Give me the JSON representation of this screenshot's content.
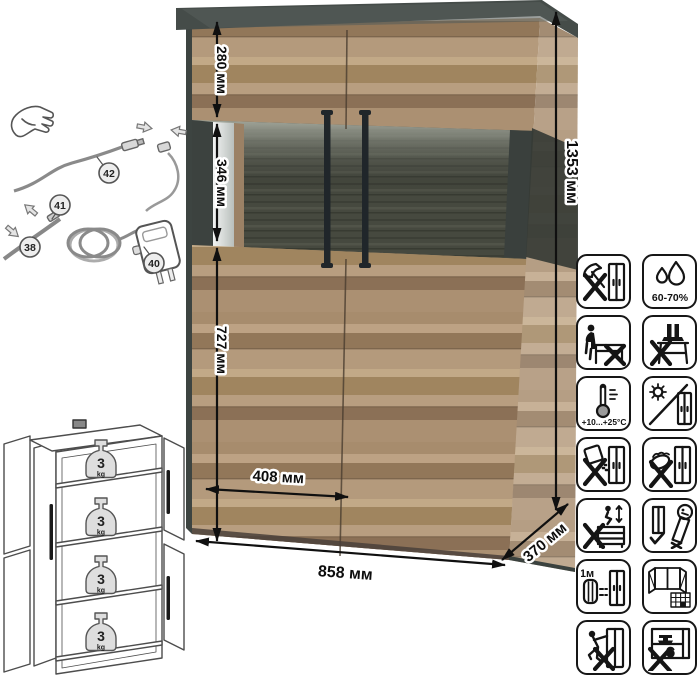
{
  "dimensions": {
    "height": "1353 мм",
    "width": "858 мм",
    "depth": "370 мм",
    "top_section": "280 мм",
    "glass_section": "346 мм",
    "lower_section": "727 мм",
    "door_width": "408 мм"
  },
  "wiring": {
    "callouts": [
      "42",
      "41",
      "38",
      "40"
    ]
  },
  "load": {
    "value": "3",
    "unit": "kg",
    "shelves": 4
  },
  "care": {
    "humidity": "60-70%",
    "temperature": "+10...+25°C",
    "distance": "≥1м",
    "icons": [
      "no-chopping-impact",
      "humidity-60-70",
      "no-sitting",
      "no-standing-on-top",
      "temperature-range",
      "no-direct-sunlight",
      "no-abrasive-cleaners",
      "no-wet-cleaning",
      "no-jumping-climbing",
      "transport-upright-only",
      "keep-1m-from-heaters",
      "ventilate-room",
      "no-dragging-tilting",
      "no-heavy-objects-inside"
    ]
  },
  "colors": {
    "wood": "#b09577",
    "graphite": "#454c49",
    "glass_back": "#46493f",
    "handle": "#20262a",
    "line_art": "#555555"
  }
}
